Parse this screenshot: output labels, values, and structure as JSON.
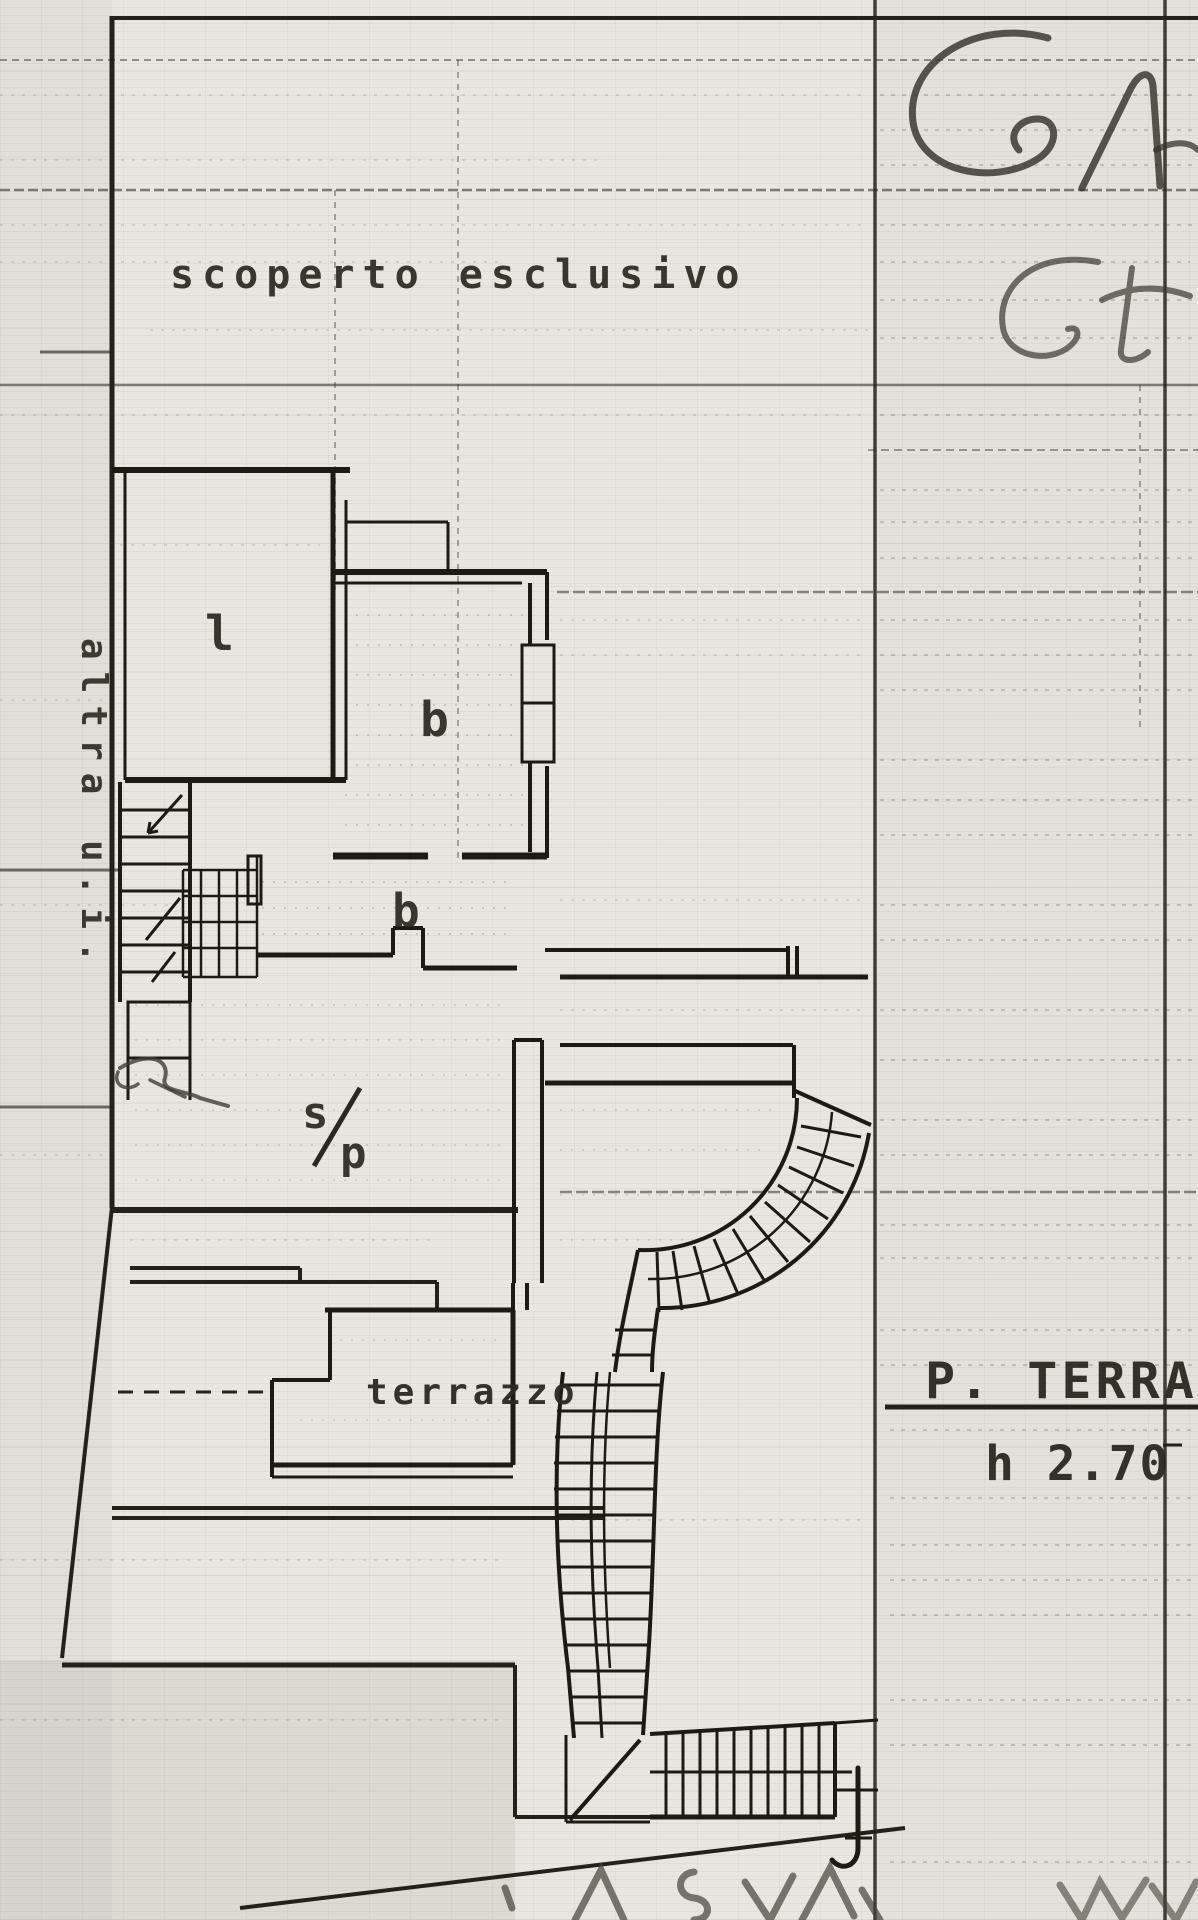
{
  "page": {
    "background": "#e8e6e1",
    "ink": "#26231d",
    "pencil": "#3f3c34"
  },
  "plan": {
    "area_label": "scoperto esclusivo",
    "side_label": "altra u.i.",
    "room_l": "l",
    "room_b_upper": "b",
    "room_b_lower": "b",
    "living_s": "s",
    "living_p": "p",
    "terrace": "terrazzo",
    "floor_title": "P. TERRA",
    "floor_height": "h 2.70",
    "handwriting_top": "GA",
    "handwriting_mid": "Gt"
  }
}
